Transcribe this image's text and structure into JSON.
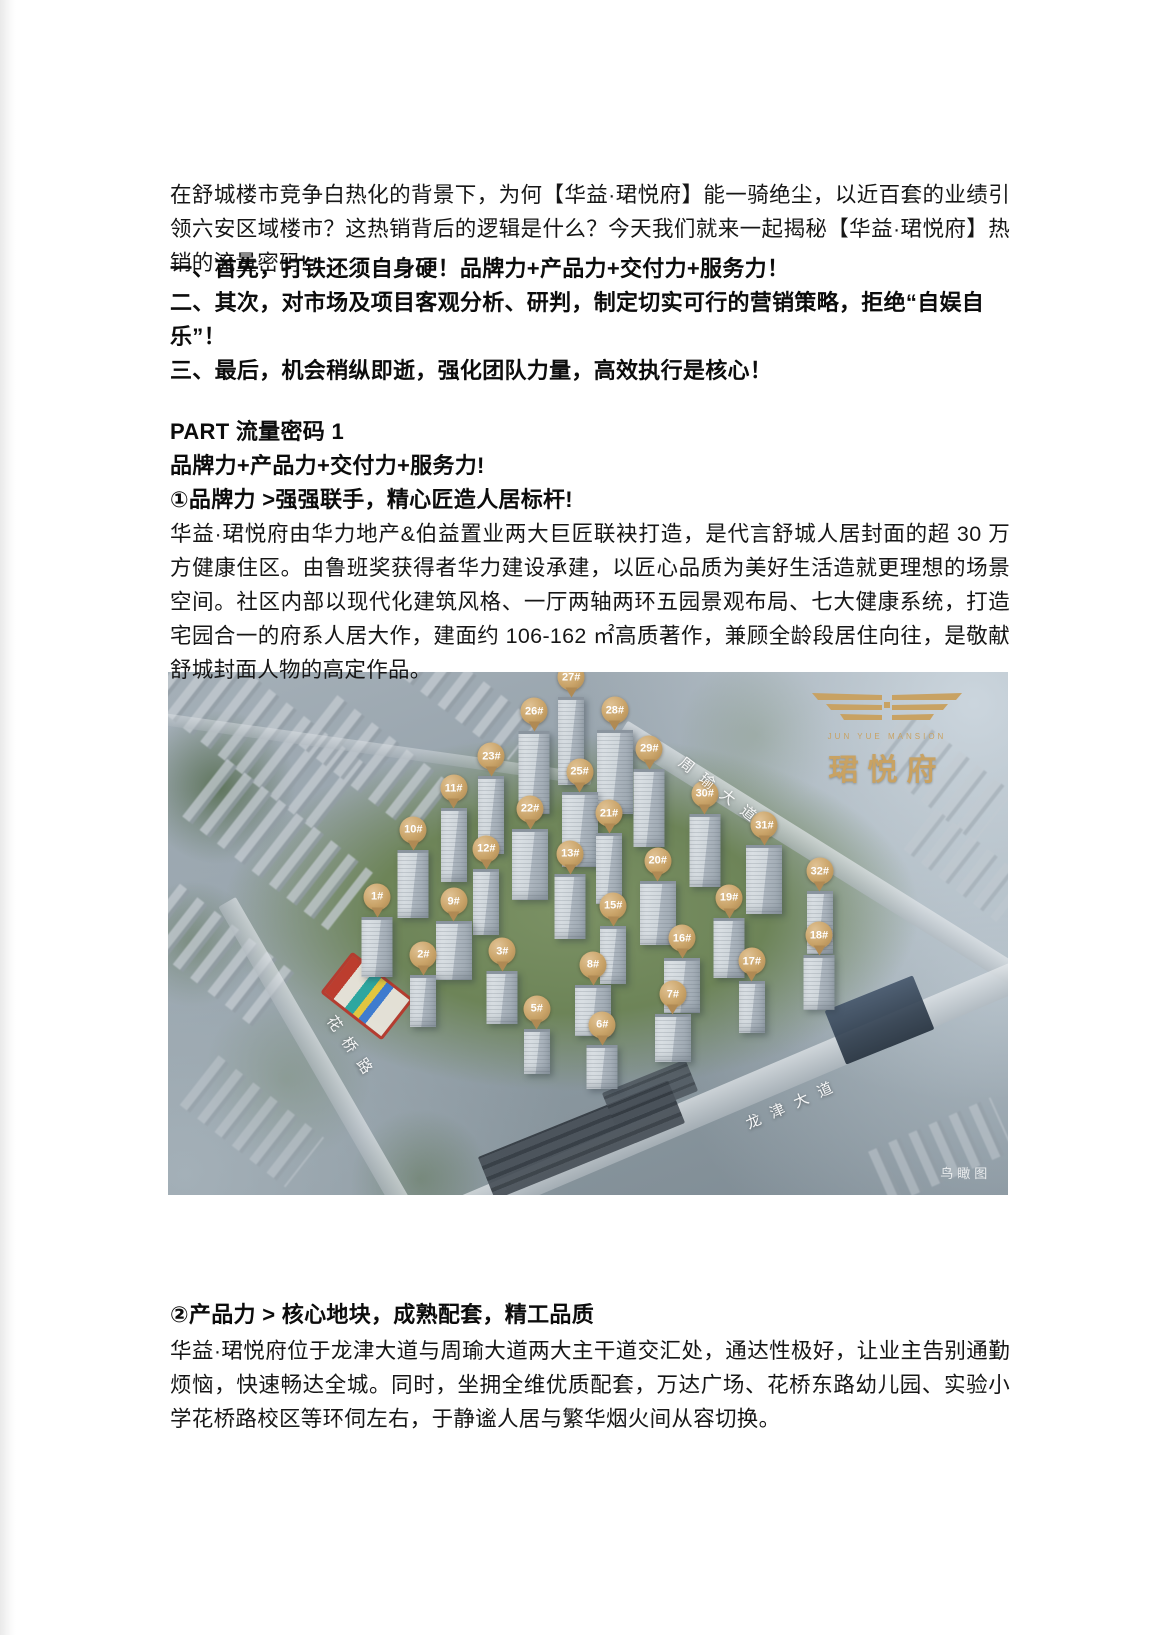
{
  "page": {
    "intro": "在舒城楼市竞争白热化的背景下，为何【华益·珺悦府】能一骑绝尘，以近百套的业绩引领六安区域楼市？这热销背后的逻辑是什么？今天我们就来一起揭秘【华益·珺悦府】热销的流量密码!",
    "key_points": [
      "一、首先，打铁还须自身硬！品牌力+产品力+交付力+服务力！",
      "二、其次，对市场及项目客观分析、研判，制定切实可行的营销策略，拒绝“自娱自乐”！",
      "三、最后，机会稍纵即逝，强化团队力量，高效执行是核心！"
    ],
    "part_heading": "PART 流量密码 1",
    "part_subheading": "品牌力+产品力+交付力+服务力!",
    "section1": {
      "heading": "①品牌力 >强强联手，精心匠造人居标杆!",
      "body": "华益·珺悦府由华力地产&伯益置业两大巨匠联袂打造，是代言舒城人居封面的超 30 万方健康住区。由鲁班奖获得者华力建设承建，以匠心品质为美好生活造就更理想的场景空间。社区内部以现代化建筑风格、一厅两轴两环五园景观布局、七大健康系统，打造宅园合一的府系人居大作，建面约 106-162 ㎡高质著作，兼顾全龄段居住向往，是敬献舒城封面人物的高定作品。"
    },
    "section2": {
      "heading": "②产品力 > 核心地块，成熟配套，精工品质",
      "body": "华益·珺悦府位于龙津大道与周瑜大道两大主干道交汇处，通达性极好，让业主告别通勤烦恼，快速畅达全城。同时，坐拥全维优质配套，万达广场、花桥东路幼儿园、实验小学花桥路校区等环伺左右，于静谧人居与繁华烟火间从容切换。"
    }
  },
  "aerial": {
    "logo": {
      "cn": "珺悦府",
      "en": "JUN YUE MANSION"
    },
    "watermark": "鸟瞰图",
    "colors": {
      "gold": "#c8a263",
      "marker_gold": "#c9a368"
    },
    "roads": [
      {
        "name": "周瑜大道",
        "x": 66.0,
        "y": 23.0,
        "angle": 38
      },
      {
        "name": "花桥路",
        "x": 22.0,
        "y": 72.0,
        "angle": 55
      },
      {
        "name": "龙津大道",
        "x": 74.5,
        "y": 82.5,
        "angle": -24
      }
    ],
    "markers": [
      {
        "label": "27#",
        "x": 48.0,
        "y": 5.2
      },
      {
        "label": "26#",
        "x": 43.6,
        "y": 11.7
      },
      {
        "label": "28#",
        "x": 53.2,
        "y": 11.5
      },
      {
        "label": "23#",
        "x": 38.5,
        "y": 20.3
      },
      {
        "label": "29#",
        "x": 57.3,
        "y": 18.9
      },
      {
        "label": "25#",
        "x": 49.0,
        "y": 23.3
      },
      {
        "label": "11#",
        "x": 34.0,
        "y": 26.4
      },
      {
        "label": "30#",
        "x": 63.9,
        "y": 27.5
      },
      {
        "label": "22#",
        "x": 43.1,
        "y": 30.4
      },
      {
        "label": "21#",
        "x": 52.5,
        "y": 31.2
      },
      {
        "label": "10#",
        "x": 29.2,
        "y": 34.4
      },
      {
        "label": "31#",
        "x": 71.0,
        "y": 33.5
      },
      {
        "label": "12#",
        "x": 37.9,
        "y": 38.0
      },
      {
        "label": "13#",
        "x": 47.9,
        "y": 39.0
      },
      {
        "label": "20#",
        "x": 58.3,
        "y": 40.3
      },
      {
        "label": "32#",
        "x": 77.6,
        "y": 42.3
      },
      {
        "label": "1#",
        "x": 24.9,
        "y": 47.2
      },
      {
        "label": "9#",
        "x": 34.0,
        "y": 48.0
      },
      {
        "label": "15#",
        "x": 53.0,
        "y": 48.9
      },
      {
        "label": "19#",
        "x": 66.8,
        "y": 47.4
      },
      {
        "label": "16#",
        "x": 61.2,
        "y": 55.1
      },
      {
        "label": "2#",
        "x": 30.4,
        "y": 58.3
      },
      {
        "label": "3#",
        "x": 39.8,
        "y": 57.6
      },
      {
        "label": "8#",
        "x": 50.6,
        "y": 60.2
      },
      {
        "label": "17#",
        "x": 69.5,
        "y": 59.5
      },
      {
        "label": "18#",
        "x": 77.5,
        "y": 54.5
      },
      {
        "label": "7#",
        "x": 60.1,
        "y": 65.8
      },
      {
        "label": "5#",
        "x": 43.9,
        "y": 68.6
      },
      {
        "label": "6#",
        "x": 51.7,
        "y": 71.7
      }
    ]
  }
}
